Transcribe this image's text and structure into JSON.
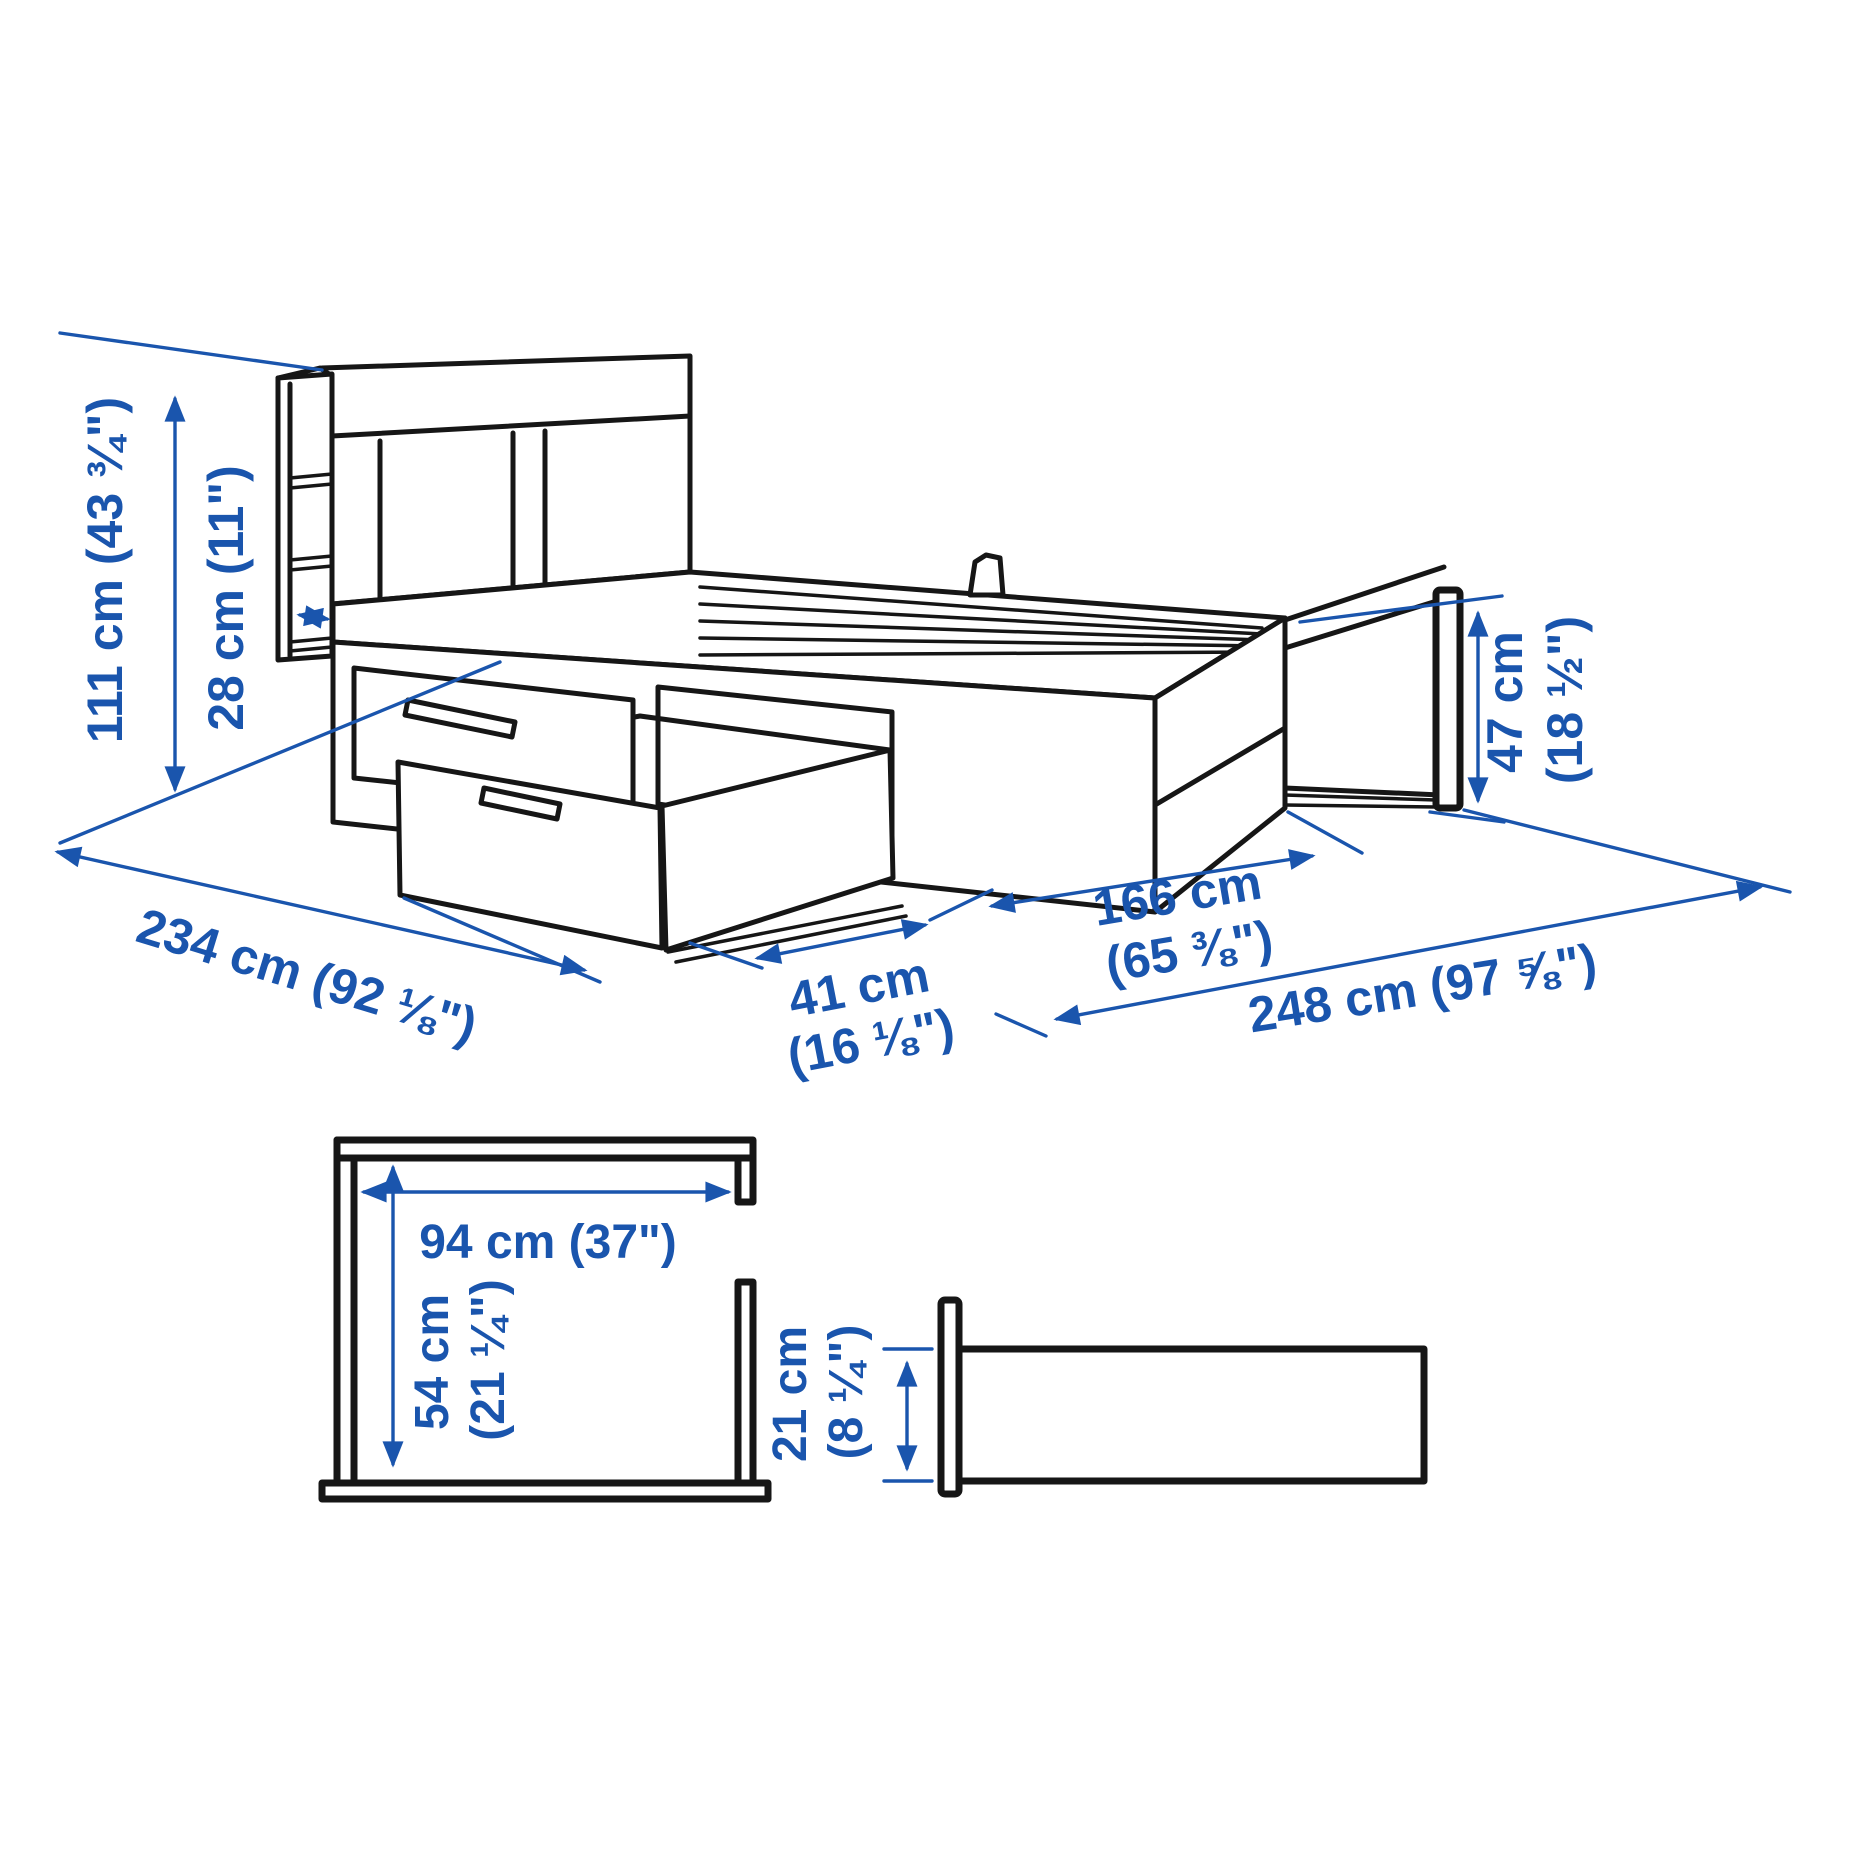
{
  "figure": {
    "kind": "furniture-dimension-diagram",
    "background_color": "#ffffff",
    "line_color": "#161616",
    "accent_color": "#1a55ad",
    "dimensions": {
      "height_total": "111 cm (43 ¾\")",
      "headboard_depth": "28 cm (11\")",
      "length_total": "234 cm (92 ⅛\")",
      "drawer_clearance_cm": "41 cm",
      "drawer_clearance_in": "(16 ⅛\")",
      "width_total_cm": "166 cm",
      "width_total_in": "(65 ⅜\")",
      "clearance_total": "248 cm (97 ⅝\")",
      "footboard_height_cm": "47 cm",
      "footboard_height_in": "(18 ½\")",
      "headboard_clear_width": "94 cm (37\")",
      "headboard_clear_height_cm": "54 cm",
      "headboard_clear_height_in": "(21 ¼\")",
      "rail_height_cm": "21 cm",
      "rail_height_in": "(8 ¼\")"
    }
  }
}
